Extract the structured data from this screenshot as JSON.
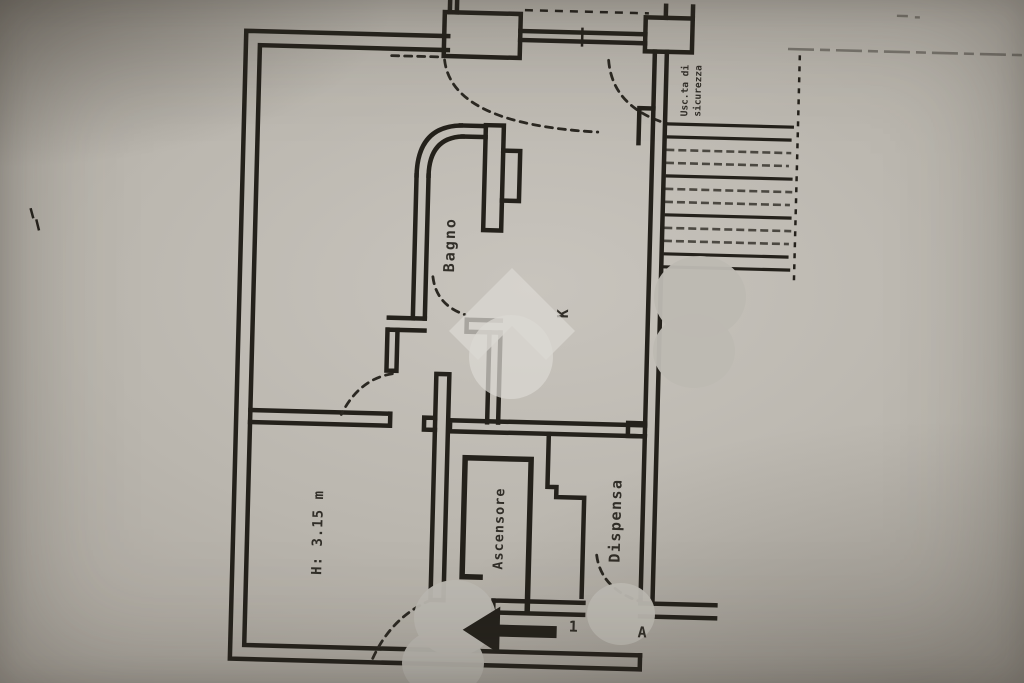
{
  "plan": {
    "rooms": {
      "bathroom": "Bagno",
      "kitchen": "K",
      "pantry": "Dispensa",
      "elevator": "Ascensore",
      "height_note": "H: 3.15 m"
    },
    "exits": {
      "emergency_line1": "Usc.ta di",
      "emergency_line2": "sicurezza"
    },
    "markers": {
      "section_1": "1",
      "section_a": "A"
    }
  },
  "colors": {
    "wall": "#24211b",
    "paper": "#b8b4ac",
    "watermark": "#dbd8d2",
    "redaction": "#bcb9b2"
  }
}
